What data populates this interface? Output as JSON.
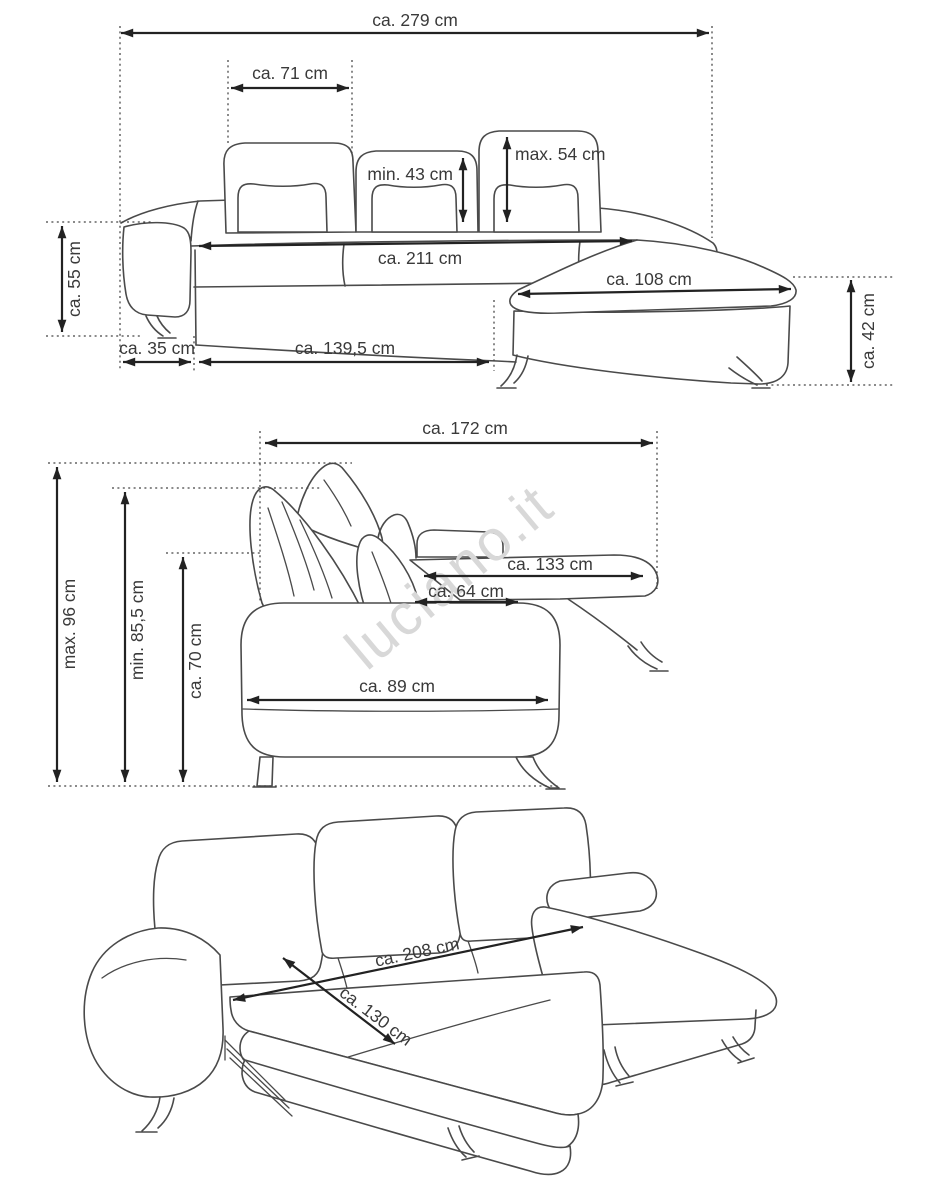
{
  "watermark": {
    "text": "luciano.it",
    "color": "#d8d8d8"
  },
  "colors": {
    "outline": "#4a4a4a",
    "dimension_line": "#222222",
    "label_text": "#3a3a3a",
    "background": "#ffffff"
  },
  "views": {
    "front": {
      "title": "sofa front view with chaise",
      "dims": {
        "total_width": "ca. 279 cm",
        "back_cushion_width": "ca. 71 cm",
        "backrest_min_height": "min. 43 cm",
        "backrest_max_height": "max. 54 cm",
        "seat_width": "ca. 211 cm",
        "chaise_width": "ca. 108 cm",
        "left_side_height": "ca. 55 cm",
        "armrest_width": "ca. 35 cm",
        "base_front_length": "ca. 139,5 cm",
        "chaise_height": "ca. 42 cm"
      }
    },
    "side": {
      "title": "sofa side view",
      "dims": {
        "total_depth": "ca. 172 cm",
        "max_height": "max. 96 cm",
        "min_height": "min. 85,5 cm",
        "armrest_height": "ca. 70 cm",
        "chaise_depth": "ca. 133 cm",
        "seat_depth": "ca. 64 cm",
        "armrest_depth": "ca. 89 cm"
      }
    },
    "bed": {
      "title": "sofa bed unfolded perspective view",
      "dims": {
        "bed_length": "ca. 208 cm",
        "bed_width": "ca. 130 cm"
      }
    }
  }
}
